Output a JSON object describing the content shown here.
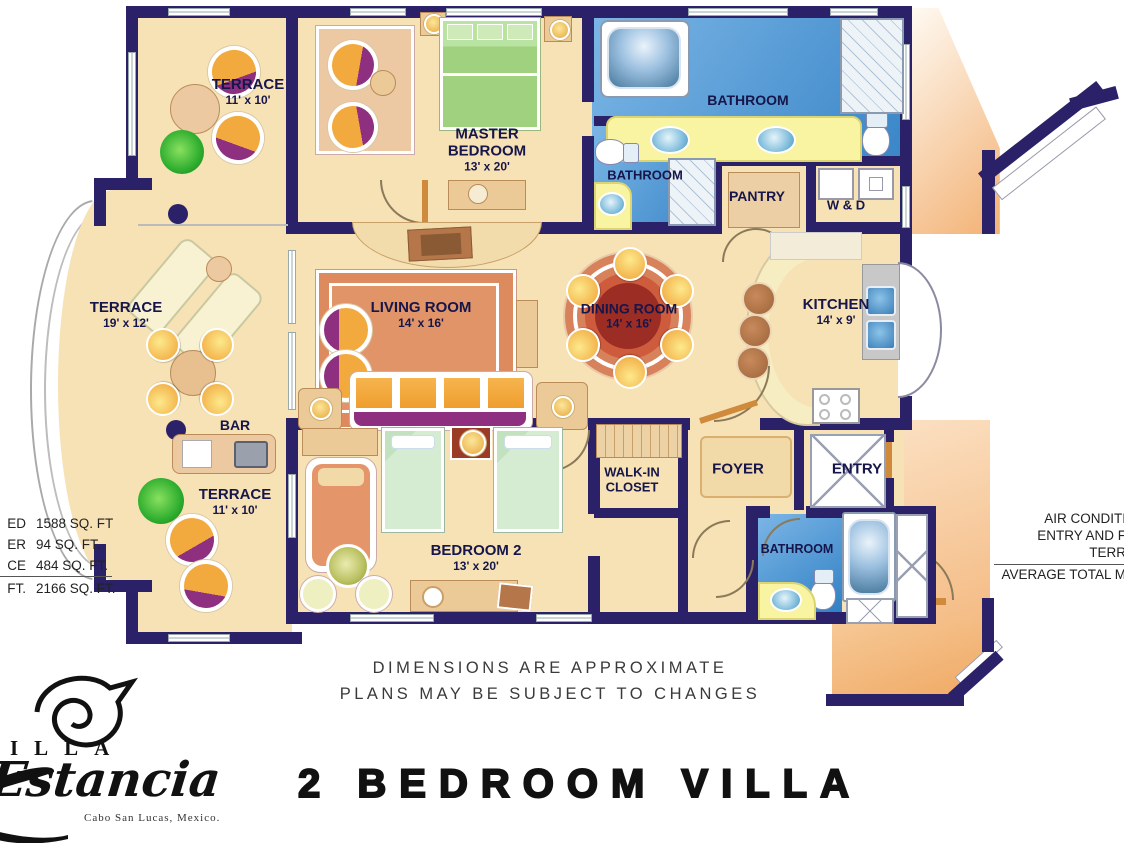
{
  "branding": {
    "brand_visible": "ILLA",
    "brand_script": "Estancia",
    "brand_location": "Cabo San Lucas, Mexico.",
    "plan_title": "2 BEDROOM VILLA"
  },
  "disclaimer": {
    "line1": "DIMENSIONS ARE APPROXIMATE",
    "line2": "PLANS MAY BE SUBJECT TO CHANGES"
  },
  "area_summary": {
    "rows": [
      {
        "label": "ED",
        "value": "1588 SQ. FT"
      },
      {
        "label": "ER",
        "value": "94 SQ. FT."
      },
      {
        "label": "CE",
        "value": "484 SQ. FT."
      },
      {
        "label": "FT.",
        "value": "2166 SQ. FT."
      }
    ]
  },
  "right_summary": {
    "line1": "AIR CONDITI",
    "line2": "ENTRY AND F",
    "line3": "TERR",
    "line4": "AVERAGE TOTAL M"
  },
  "rooms": {
    "terrace_top": {
      "name": "TERRACE",
      "dims": "11' x 10'"
    },
    "master_bedroom": {
      "name": "MASTER BEDROOM",
      "dims": "13' x 20'"
    },
    "master_bathroom": {
      "name": "BATHROOM"
    },
    "guest_bathroom": {
      "name": "BATHROOM"
    },
    "pantry": {
      "name": "PANTRY"
    },
    "washer_dryer": {
      "name": "W & D"
    },
    "terrace_main": {
      "name": "TERRACE",
      "dims": "19' x 12'"
    },
    "living_room": {
      "name": "LIVING ROOM",
      "dims": "14' x 16'"
    },
    "dining_room": {
      "name": "DINING ROOM",
      "dims": "14' x 16'"
    },
    "kitchen": {
      "name": "KITCHEN",
      "dims": "14' x 9'"
    },
    "bar": {
      "name": "BAR"
    },
    "terrace_bottom": {
      "name": "TERRACE",
      "dims": "11' x 10'"
    },
    "bedroom_2": {
      "name": "BEDROOM 2",
      "dims": "13' x 20'"
    },
    "walk_in_closet": {
      "name": "WALK-IN CLOSET"
    },
    "foyer": {
      "name": "FOYER"
    },
    "entry": {
      "name": "ENTRY"
    },
    "bathroom_2": {
      "name": "BATHROOM"
    }
  },
  "colors": {
    "wall": "#2a2168",
    "floor": "#f7e2b5",
    "bathroom_blue": "#3c8fd0",
    "counter_yellow": "#f8f4a2",
    "rug_terracotta": "#dd8a5f",
    "furniture_orange": "#f2a93e",
    "accent_purple": "#8e2f80",
    "bed_green": "#a2d687",
    "bed_mint": "#d5ecd2",
    "exterior_peach": "#f2ae6e"
  }
}
